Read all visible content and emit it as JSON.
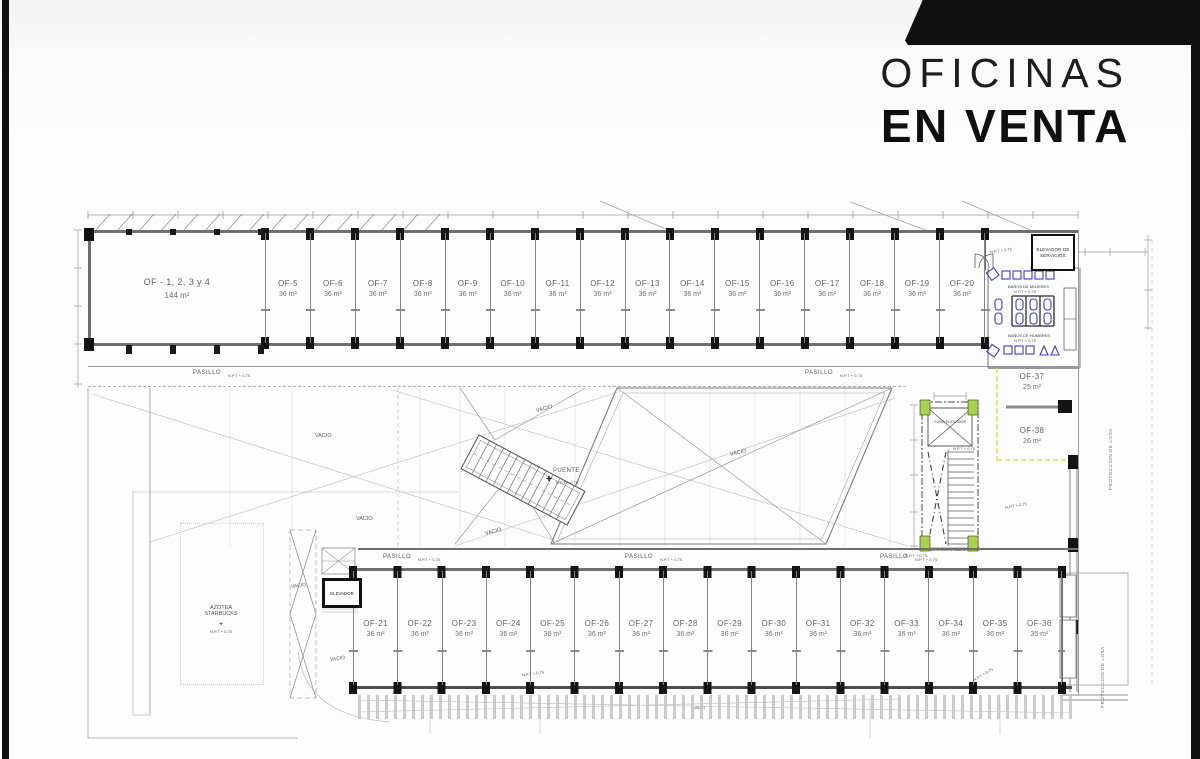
{
  "title": {
    "line1": "OFICINAS",
    "line2": "EN VENTA"
  },
  "plan": {
    "big_office": {
      "name": "OF - 1, 2, 3 y 4",
      "area": "144 m²"
    },
    "top_offices": [
      {
        "name": "OF-5",
        "area": "36 m²"
      },
      {
        "name": "OF-6",
        "area": "36 m²"
      },
      {
        "name": "OF-7",
        "area": "36 m²"
      },
      {
        "name": "OF-8",
        "area": "36 m²"
      },
      {
        "name": "OF-9",
        "area": "36 m²"
      },
      {
        "name": "OF-10",
        "area": "36 m²"
      },
      {
        "name": "OF-11",
        "area": "36 m²"
      },
      {
        "name": "OF-12",
        "area": "36 m²"
      },
      {
        "name": "OF-13",
        "area": "36 m²"
      },
      {
        "name": "OF-14",
        "area": "36 m²"
      },
      {
        "name": "OF-15",
        "area": "36 m²"
      },
      {
        "name": "OF-16",
        "area": "36 m²"
      },
      {
        "name": "OF-17",
        "area": "36 m²"
      },
      {
        "name": "OF-18",
        "area": "36 m²"
      },
      {
        "name": "OF-19",
        "area": "36 m²"
      },
      {
        "name": "OF-20",
        "area": "36 m²"
      }
    ],
    "bottom_offices": [
      {
        "name": "OF-21",
        "area": "36 m²"
      },
      {
        "name": "OF-22",
        "area": "36 m²"
      },
      {
        "name": "OF-23",
        "area": "36 m²"
      },
      {
        "name": "OF-24",
        "area": "36 m²"
      },
      {
        "name": "OF-25",
        "area": "36 m²"
      },
      {
        "name": "OF-26",
        "area": "36 m²"
      },
      {
        "name": "OF-27",
        "area": "36 m²"
      },
      {
        "name": "OF-28",
        "area": "36 m²"
      },
      {
        "name": "OF-29",
        "area": "36 m²"
      },
      {
        "name": "OF-30",
        "area": "36 m²"
      },
      {
        "name": "OF-31",
        "area": "36 m²"
      },
      {
        "name": "OF-32",
        "area": "36 m²"
      },
      {
        "name": "OF-33",
        "area": "36 m²"
      },
      {
        "name": "OF-34",
        "area": "36 m²"
      },
      {
        "name": "OF-35",
        "area": "36 m²"
      },
      {
        "name": "OF-36",
        "area": "35 m²"
      }
    ],
    "right_offices": [
      {
        "name": "OF-37",
        "area": "25 m²"
      },
      {
        "name": "OF-38",
        "area": "26 m²"
      }
    ],
    "labels": {
      "pasillo": "PASILLO",
      "npt": "N.P.T + 0.75",
      "vacio": "VACIO",
      "puente": "PUENTE",
      "elevador": "ELEVADOR",
      "elevador_servicios": "ELEVADOR DE SERVICIOS",
      "cubo_elevador": "CUBO ELEVADOR",
      "banos_mujeres": "BAÑOS DE MUJERES",
      "banos_hombres": "BAÑOS DE HOMBRES",
      "azotea_1": "AZOTEA",
      "azotea_2": "STARBUCKS",
      "plus": "+",
      "proyeccion_losa": "PROYECCION DE LOSA"
    },
    "colors": {
      "column_green": "#a9d44b",
      "fixture_blue": "#3d3dc0",
      "boundary_yellow": "#d9e04e",
      "line_dark": "#444444"
    }
  }
}
